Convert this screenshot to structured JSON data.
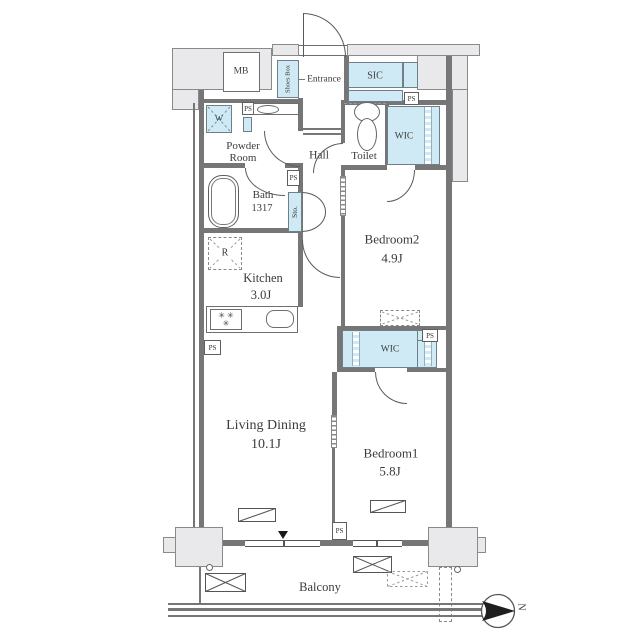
{
  "colors": {
    "accent_blue": "#cfe9f5",
    "wall_fill": "#e9e9ec",
    "wall_line": "#6e6e6e",
    "text": "#3b3b3b"
  },
  "rooms": {
    "living": {
      "name": "Living Dining",
      "size": "10.1J"
    },
    "bedroom1": {
      "name": "Bedroom1",
      "size": "5.8J"
    },
    "bedroom2": {
      "name": "Bedroom2",
      "size": "4.9J"
    },
    "kitchen": {
      "name": "Kitchen",
      "size": "3.0J"
    },
    "bath": {
      "name": "Bath",
      "size": "1317"
    },
    "powder_room": {
      "line1": "Powder",
      "line2": "Room"
    },
    "hall": {
      "name": "Hall"
    },
    "toilet": {
      "name": "Toilet"
    },
    "entrance": {
      "name": "Entrance"
    },
    "balcony": {
      "name": "Balcony"
    }
  },
  "closets": {
    "sic": "SIC",
    "wic": "WIC",
    "shoes_box": "Shoes Box",
    "storage": "Sto."
  },
  "fixtures": {
    "mb": "MB",
    "ps": "PS",
    "washer": "W",
    "fridge": "R",
    "burners_row1": "✳ ✳",
    "burners_row2": "✳"
  },
  "compass": {
    "north": "N"
  }
}
